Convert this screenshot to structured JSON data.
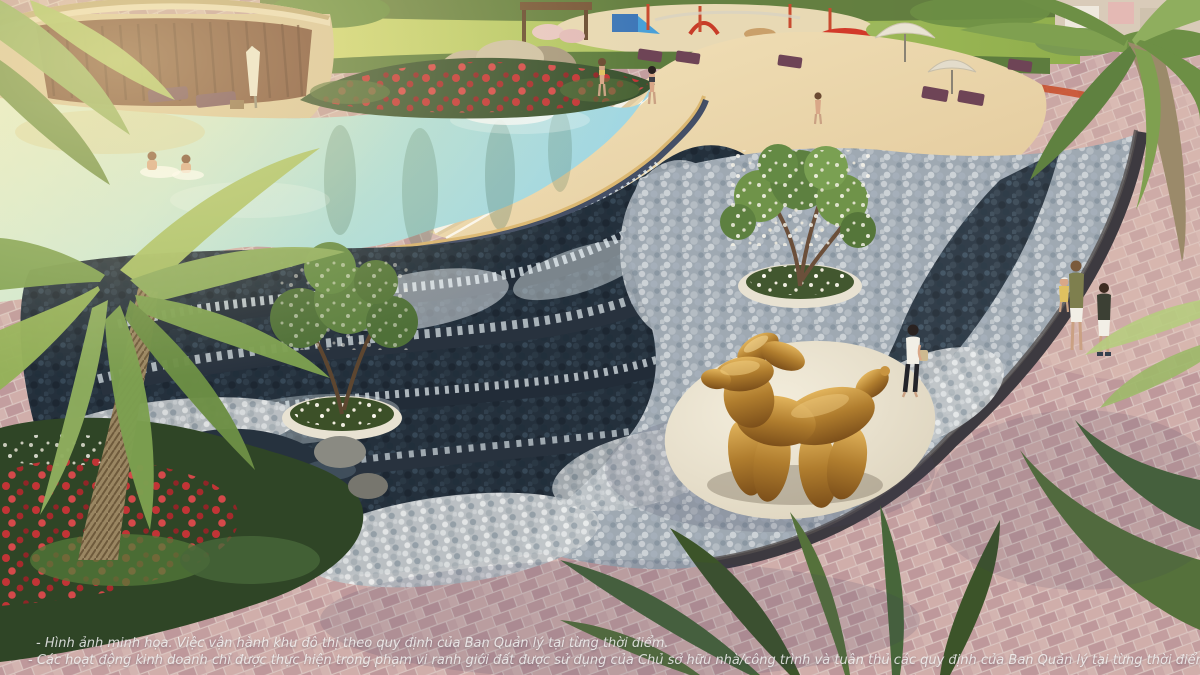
{
  "scene": {
    "description": "Aerial architectural render of a resort lagoon pool with rock waterfall, sand beach, terraced water cascades, pebble stream, golden balloon-dog sculpture on a white plaza, pink paver promenade, palms and flower beds",
    "objects": {
      "pavilion": "clubhouse pavilion with curved bronze roof",
      "pool": "turquoise lagoon swimming pool",
      "waterfall_rock": "rock waterfall feature",
      "beach": "sand beach entry with loungers and umbrellas",
      "playground": "children playground with blue slide",
      "cascades": "terraced dark-stone water cascades",
      "pebble_stream": "pebble bed with dark stream",
      "plaza": "white oval plaza",
      "sculpture": "golden balloon dog sculpture",
      "promenade": "pink paver walking path"
    },
    "colors": {
      "pool_water": "#a8dcda",
      "pool_shallow": "#e3edcc",
      "sand": "#ead7ae",
      "paver": "#cba8a5",
      "pebble": "#9fa9b2",
      "stream_dark": "#26323e",
      "foam_white": "#eaf2f5",
      "lawn": "#a3bd5e",
      "hedge": "#5d7c3e",
      "gold_sculpture": "#b07d2e",
      "plaza_white": "#ece4d2",
      "flower_red": "#c03436",
      "umbrella": "#e9e3d3",
      "lounger": "#6e4456"
    }
  },
  "disclaimer": {
    "line1": "- Hình ảnh minh họa. Việc vận hành khu đô thị theo quy định của Ban Quản lý tại từng thời điểm.",
    "line2": "- Các hoạt động kinh doanh chỉ được thực hiện trong phạm vi ranh giới đất được sử dụng của Chủ sở hữu nhà/công trình và tuân thủ các quy định của Ban Quản lý tại từng thời điểm."
  }
}
